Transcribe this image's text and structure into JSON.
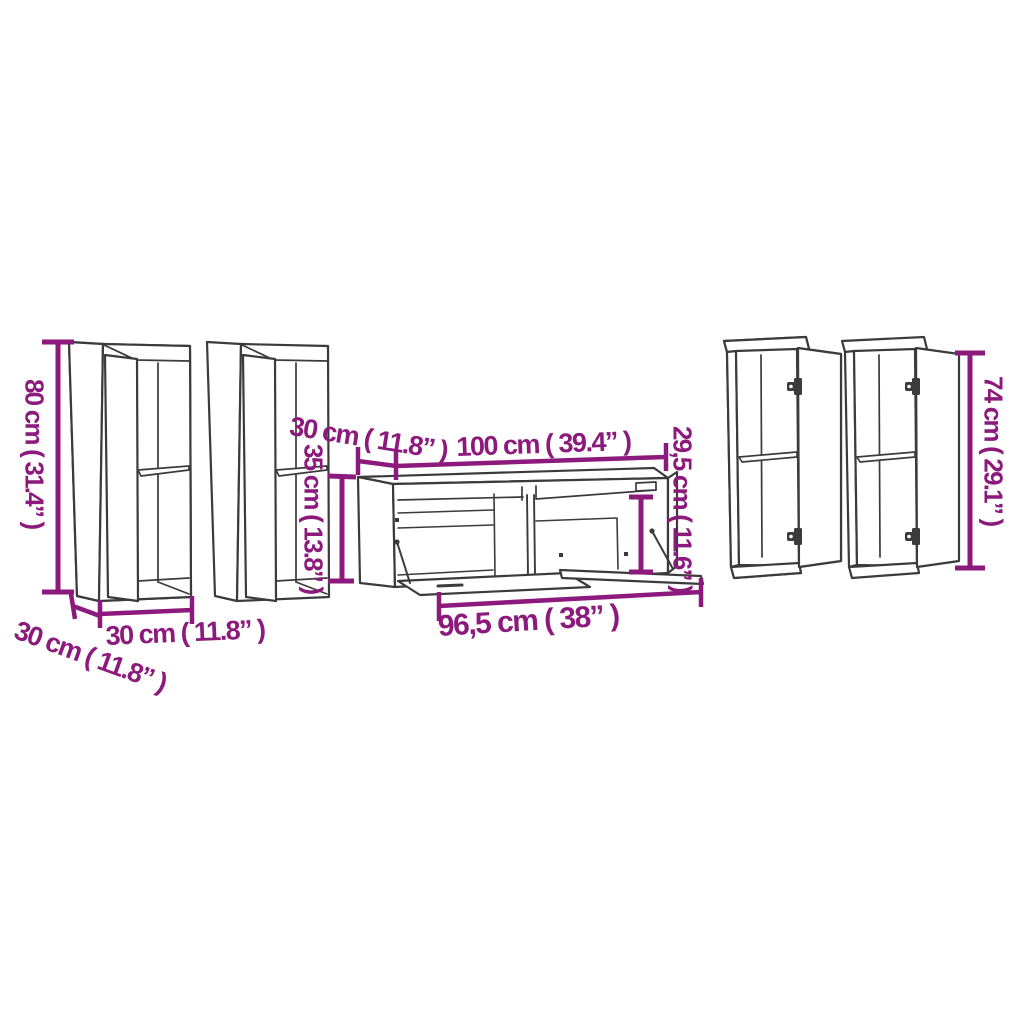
{
  "diagram": {
    "type": "furniture-dimension-drawing",
    "pieces": "5 piece TV cabinet set: two tall wall cabinets (left), TV stand (center), two wall cabinets with open doors (right)",
    "colors": {
      "background": "#ffffff",
      "line_art": "#3b3b3b",
      "dimension": "#8C1A7C"
    },
    "labels": {
      "left_cabinet_height": "80 cm ( 31.4” )",
      "left_cabinet_width": "30 cm ( 11.8” )",
      "left_cabinet_depth": "30 cm ( 11.8” )",
      "stand_depth": "30 cm ( 11.8” )",
      "stand_width": "100 cm ( 39.4” )",
      "stand_opening_height": "29,5 cm ( 11.6” )",
      "stand_height": "35 cm ( 13.8” )",
      "stand_bottom_width": "96,5 cm ( 38” )",
      "right_cabinet_height": "74 cm ( 29.1” )"
    }
  }
}
